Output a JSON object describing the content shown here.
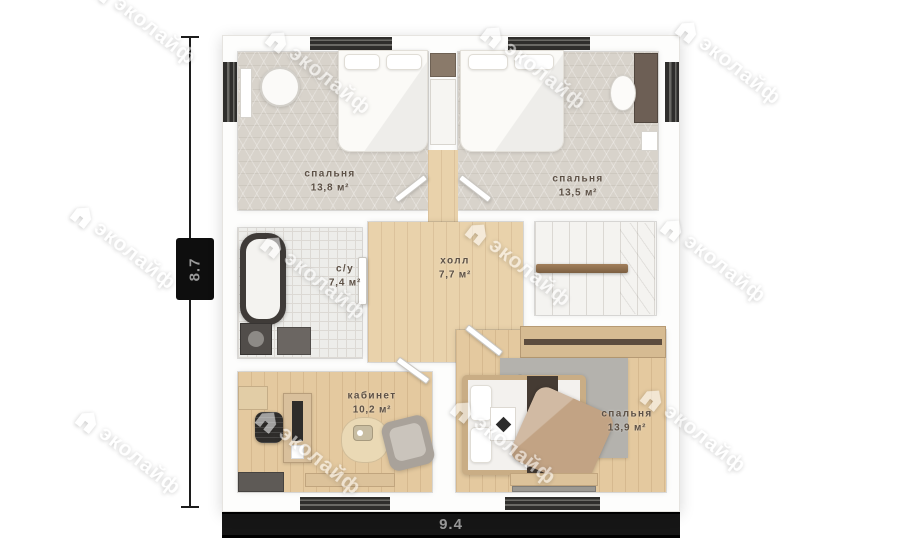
{
  "watermark": {
    "text": "эколайф"
  },
  "dimensions": {
    "width_label": "9.4",
    "height_label": "8.7"
  },
  "rooms": [
    {
      "id": "bedroom-top-left",
      "name": "спальня",
      "area": "13,8 м²"
    },
    {
      "id": "bedroom-top-right",
      "name": "спальня",
      "area": "13,5 м²"
    },
    {
      "id": "bathroom",
      "name": "с/у",
      "area": "7,4 м²"
    },
    {
      "id": "hall",
      "name": "холл",
      "area": "7,7 м²"
    },
    {
      "id": "office",
      "name": "кабинет",
      "area": "10,2 м²"
    },
    {
      "id": "bedroom-bottom",
      "name": "спальня",
      "area": "13,9 м²"
    }
  ],
  "colors": {
    "wood_floor": "#e4c99f",
    "grey_floor": "#d8d3cb",
    "tile_floor": "#ededea",
    "label_text": "#5d5146",
    "dimension_band": "#161616",
    "dimension_text": "#9a9a9a",
    "watermark": "#ffffff"
  }
}
